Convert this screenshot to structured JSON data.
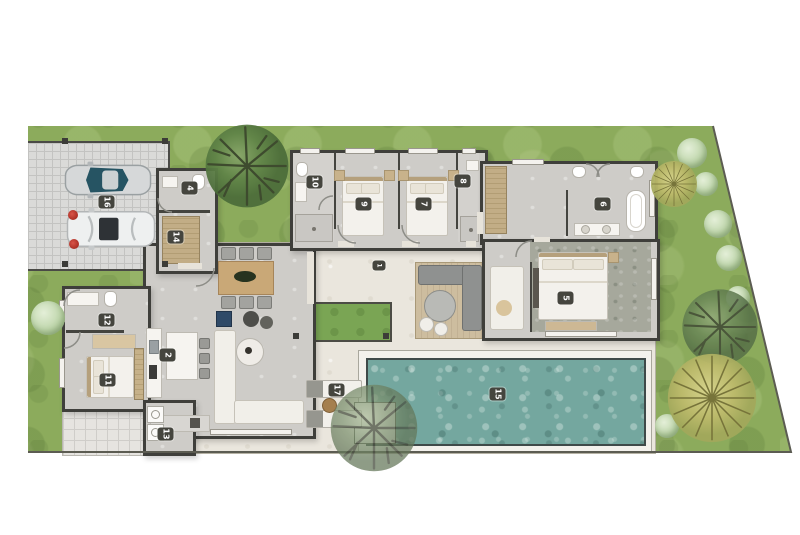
{
  "floorplan": {
    "room_labels": {
      "hall": "1",
      "kitchen": "2",
      "wc": "4",
      "master_bedroom": "5",
      "master_bathroom": "6",
      "bedroom_2": "7",
      "bathroom_2": "8",
      "bedroom_1": "9",
      "bathroom_1": "10",
      "guest_bedroom": "11",
      "guest_bathroom": "12",
      "laundry": "13",
      "entry_hall": "14",
      "pool": "15",
      "garage": "16",
      "sun_loungers": "17"
    },
    "colors": {
      "grass": "#8cab5c",
      "pool_water": "#74a7a0",
      "walls": "#3f3f3b",
      "terrace": "#e9e5dc",
      "room_floor": "#ceccc8",
      "wood_deck": "#c7b697",
      "label_background": "#45453e",
      "label_text": "#ffffff"
    }
  }
}
